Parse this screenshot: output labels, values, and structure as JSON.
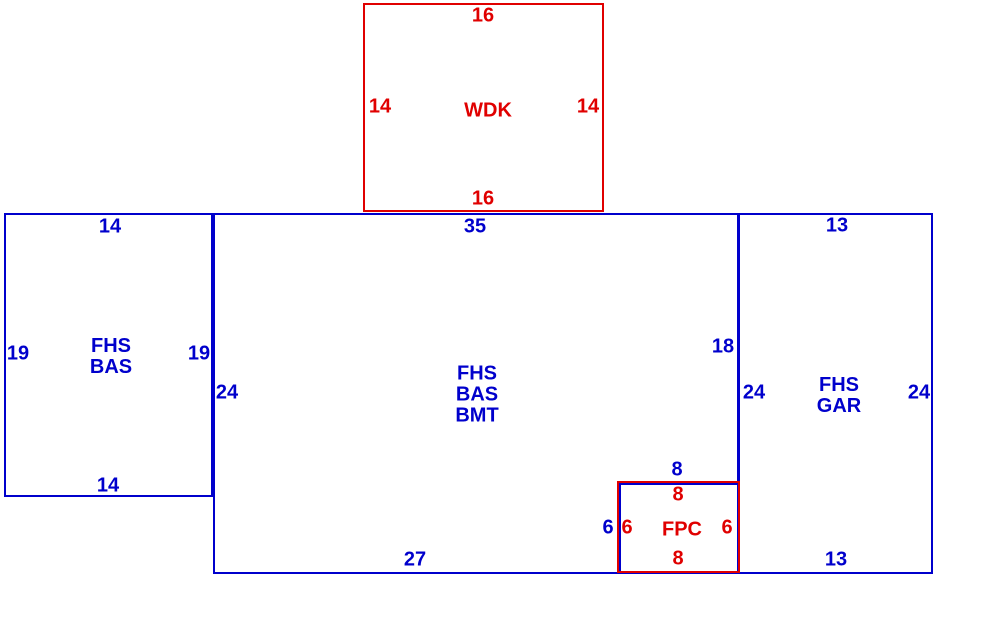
{
  "diagram": {
    "type": "property-sketch",
    "colors": {
      "blue": "#0000CC",
      "red": "#E00000",
      "background": "#FFFFFF"
    },
    "areas": [
      {
        "name": "WDK",
        "label_lines": [
          "WDK"
        ],
        "color": "red",
        "dimensions": {
          "top": "16",
          "left": "14",
          "right": "14",
          "bottom": "16"
        }
      },
      {
        "name": "FHS BAS",
        "label_lines": [
          "FHS",
          "BAS"
        ],
        "color": "blue",
        "dimensions": {
          "top": "14",
          "left": "19",
          "right": "19",
          "bottom": "14"
        }
      },
      {
        "name": "FHS BAS BMT",
        "label_lines": [
          "FHS",
          "BAS",
          "BMT"
        ],
        "color": "blue",
        "dimensions": {
          "top": "35",
          "left": "24",
          "right_upper": "18",
          "bottom": "27",
          "fpc_notch_top": "8",
          "fpc_notch_left": "6"
        }
      },
      {
        "name": "FHS GAR",
        "label_lines": [
          "FHS",
          "GAR"
        ],
        "color": "blue",
        "dimensions": {
          "top": "13",
          "left": "24",
          "right": "24",
          "bottom": "13"
        }
      },
      {
        "name": "FPC",
        "label_lines": [
          "FPC"
        ],
        "color": "red",
        "dimensions": {
          "top": "8",
          "left": "6",
          "right": "6",
          "bottom": "8"
        }
      }
    ]
  }
}
